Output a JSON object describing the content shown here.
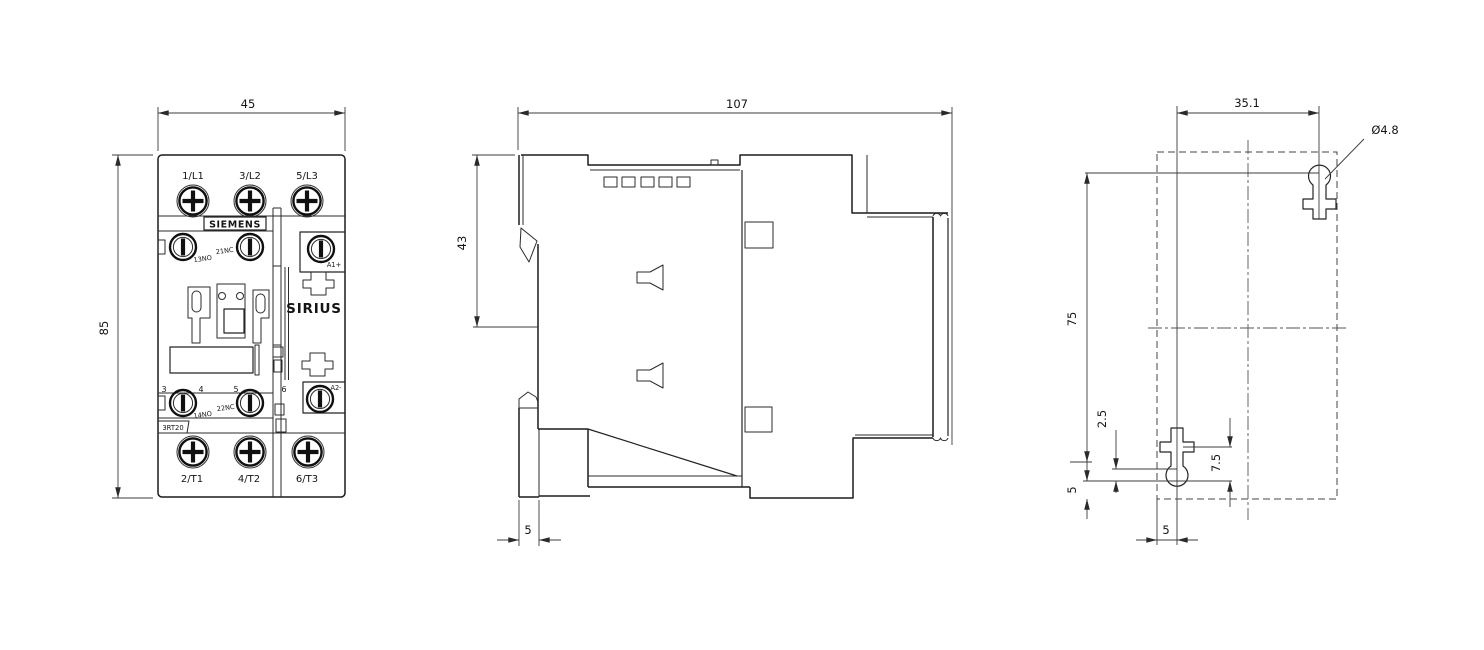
{
  "front_view": {
    "dim_width": "45",
    "dim_height": "85",
    "terminal_top_1": "1/L1",
    "terminal_top_2": "3/L2",
    "terminal_top_3": "5/L3",
    "terminal_bottom_1": "2/T1",
    "terminal_bottom_2": "4/T2",
    "terminal_bottom_3": "6/T3",
    "brand": "SIEMENS",
    "series": "SIRIUS",
    "model": "3RT20",
    "aux_no_top": "13NO",
    "aux_nc_top": "21NC",
    "aux_no_bottom": "14NO",
    "aux_nc_bottom": "22NC",
    "coil_a1": "A1+",
    "coil_a2": "A2-",
    "pole_3": "3",
    "pole_4": "4",
    "pole_5": "5",
    "pole_6": "6"
  },
  "side_view": {
    "dim_depth": "107",
    "dim_top_section": "43",
    "dim_latch_travel": "5"
  },
  "mounting_view": {
    "dim_hole_spacing_h": "35.1",
    "hole_diameter": "Ø4.8",
    "dim_hole_spacing_v": "75",
    "dim_offset_minor": "2.5",
    "dim_offset_hole": "7.5",
    "dim_offset_bottom": "5",
    "dim_offset_left": "5"
  }
}
